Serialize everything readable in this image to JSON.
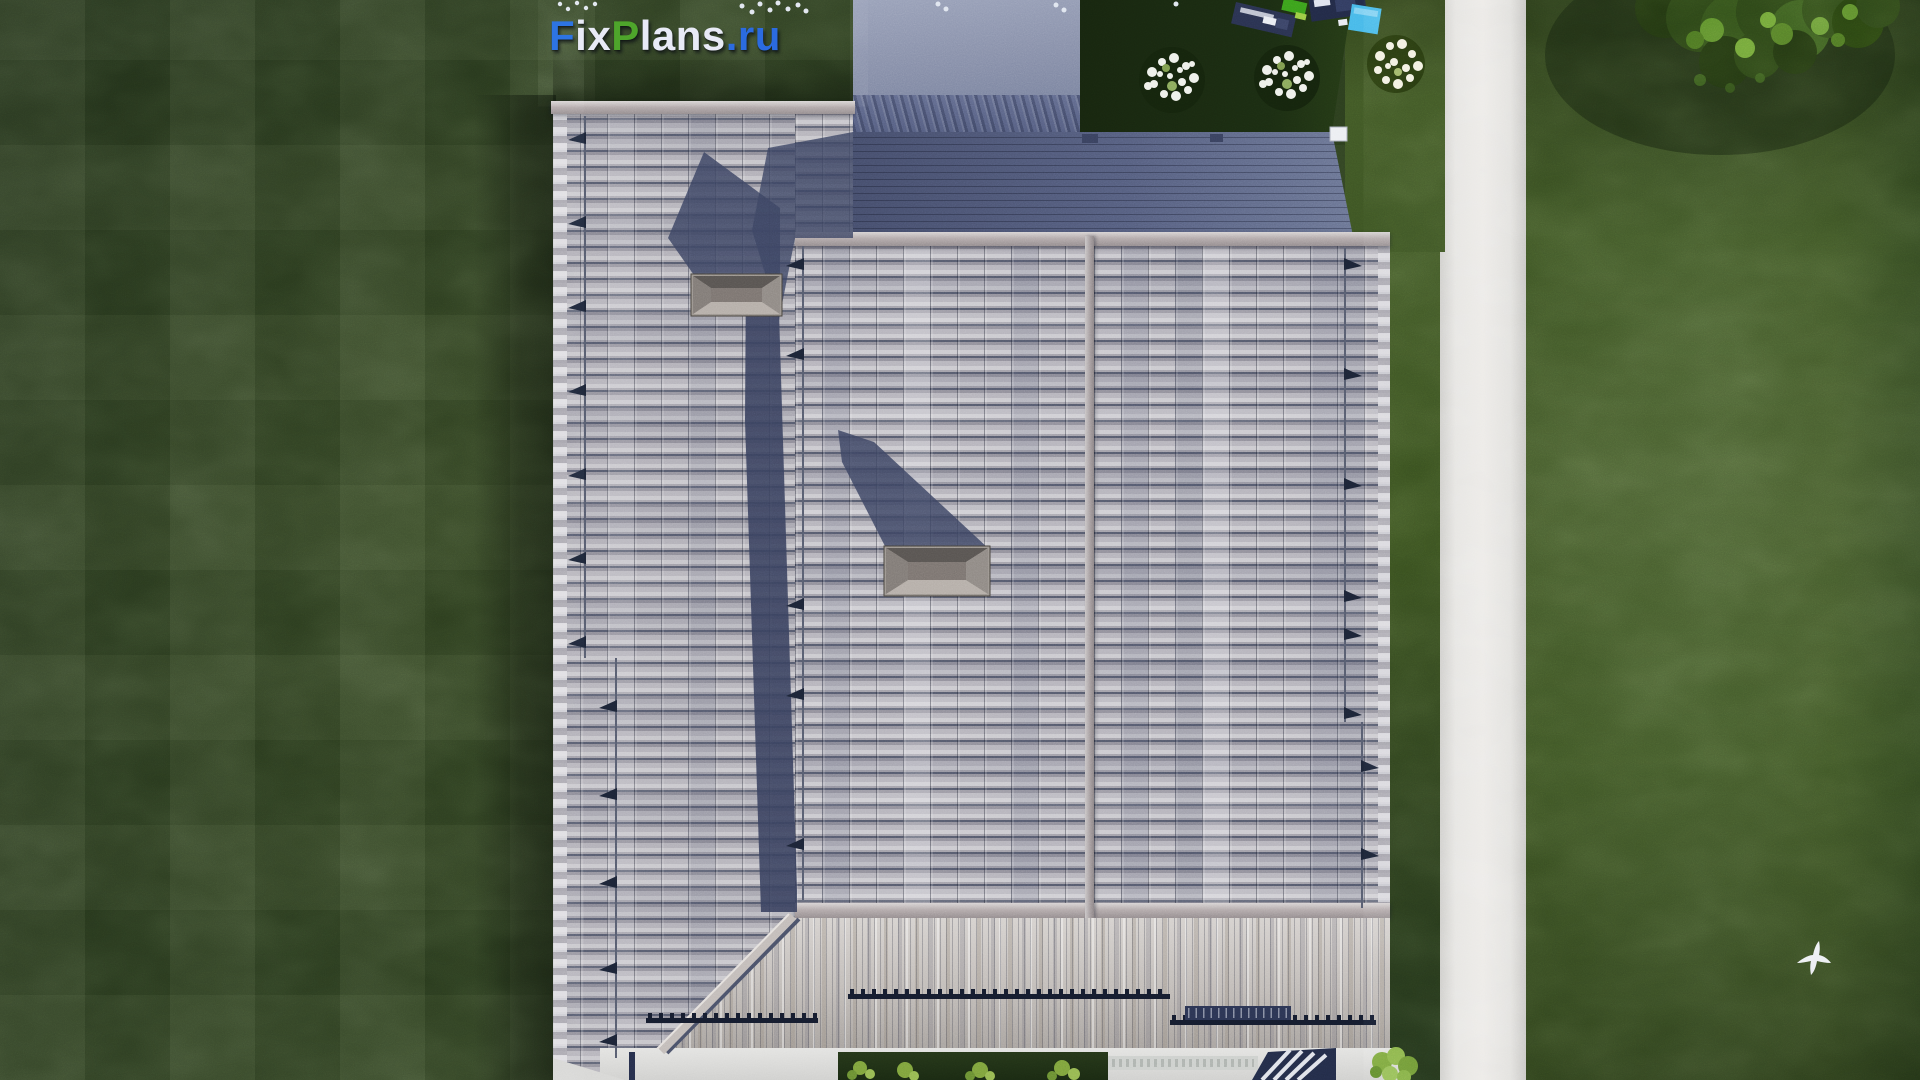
{
  "watermark": {
    "text": "FixPlans.ru",
    "segments": [
      {
        "text": "F",
        "color": "#2d74e3"
      },
      {
        "text": "ix",
        "color": "#e8eaf6"
      },
      {
        "text": "P",
        "color": "#4ea52b"
      },
      {
        "text": "lans",
        "color": "#e8eaf6"
      },
      {
        "text": ".ru",
        "color": "#2b6be0"
      }
    ]
  },
  "scene": {
    "view": "top-down aerial 3D render",
    "subject": "detached house roof plan with garden plot",
    "elements": [
      "lawn",
      "garden-path",
      "gable-roof-left-slope",
      "gable-roof-center-slope",
      "gable-roof-right-slope",
      "roof-valley-shadow",
      "skylight-hatch",
      "skylight-hatch",
      "porch-roof",
      "patio",
      "patio-steps",
      "terrace-deck",
      "driveway",
      "hedge-row",
      "flower-bushes",
      "tree-canopy",
      "flying-bird",
      "playground-equipment",
      "snow-guards",
      "roof-ladder-brackets"
    ]
  },
  "palette": {
    "lawn_dark": "#2a3b1e",
    "lawn_light": "#445b2b",
    "roof_tile_light": "#cbcacf",
    "roof_tile_mid": "#a6a4ab",
    "roof_shadow_navy": "#3a4260",
    "deck_navy": "#555e7e",
    "path_white": "#e6e5e2",
    "logo_blue": "#2d74e3",
    "logo_green": "#4ea52b",
    "logo_white": "#e8eaf6"
  }
}
